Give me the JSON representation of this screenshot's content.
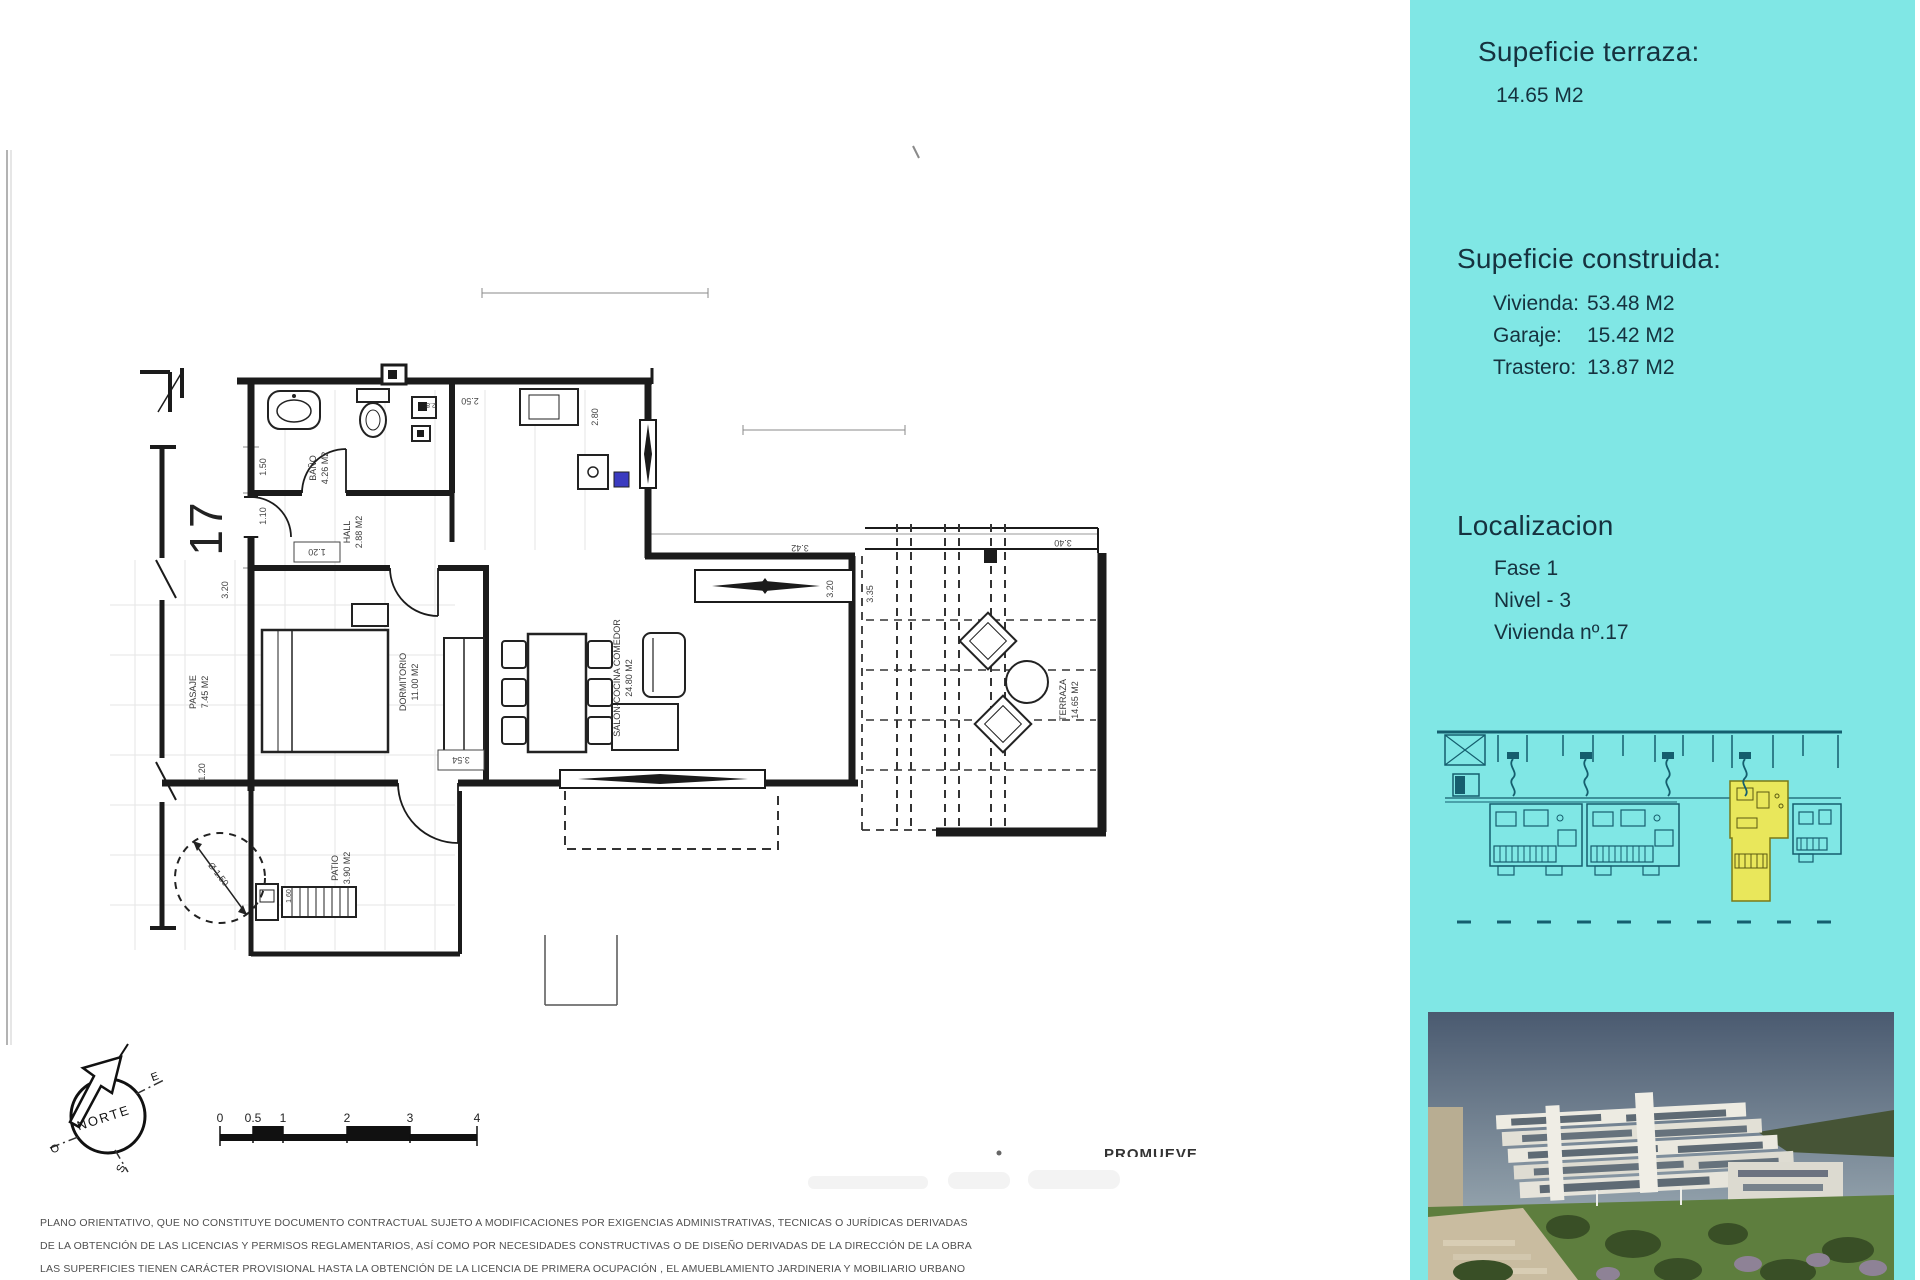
{
  "colors": {
    "panel_bg": "#80E7E5",
    "panel_text": "#16323F",
    "highlight_unit": "#E9E75B",
    "thumb_line": "#155E6E",
    "door_marker_blue": "#3B3BC0"
  },
  "sidebar": {
    "terrace": {
      "heading": "Supeficie terraza:",
      "value": "14.65 M2"
    },
    "built": {
      "heading": "Supeficie construida:",
      "rows": [
        {
          "label": "Vivienda:",
          "value": "53.48 M2"
        },
        {
          "label": "Garaje:",
          "value": "15.42 M2"
        },
        {
          "label": "Trastero:",
          "value": "13.87 M2"
        }
      ]
    },
    "location": {
      "heading": "Localizacion",
      "lines": [
        "Fase 1",
        "Nivel - 3",
        "Vivienda nº.17"
      ]
    }
  },
  "plan": {
    "unit_number": "17",
    "rooms": {
      "bano": {
        "name": "BAÑO",
        "area": "4.26 M2"
      },
      "hall": {
        "name": "HALL",
        "area": "2.88 M2"
      },
      "dormitorio": {
        "name": "DORMITORIO",
        "area": "11.00 M2"
      },
      "salon": {
        "name": "SALON-COCINA COMEDOR",
        "area": "24.80 M2"
      },
      "terraza": {
        "name": "TERRAZA",
        "area": "14.65 M2"
      },
      "pasaje": {
        "name": "PASAJE",
        "area": "7.45 M2"
      },
      "patio": {
        "name": "PATIO",
        "area": "3.90 M2"
      }
    },
    "dims": {
      "bath_height": "1.50",
      "entry_width": "1.10",
      "hall_width": "1.20",
      "passage_width": "1.20",
      "kitchen_width": "2.50",
      "kitchen_depth": "2.80",
      "bath_fixture": "2.8",
      "salon_width": "3.42",
      "salon_window": "3.20",
      "dorm_side": "3.20",
      "terrace_depth": "3.35",
      "terrace_width": "3.40",
      "dorm_width": "3.54",
      "passage_circle": "Ø 1.50",
      "patio_detail": "1.60"
    }
  },
  "compass": {
    "north": "NORTE",
    "east": "E",
    "south": "S",
    "west": "O"
  },
  "scalebar": {
    "labels": [
      "0",
      "0.5",
      "1",
      "2",
      "3",
      "4"
    ]
  },
  "footer": {
    "promoter": "PROMUEVE",
    "disclaimer": [
      "PLANO ORIENTATIVO, QUE NO CONSTITUYE DOCUMENTO CONTRACTUAL SUJETO A MODIFICACIONES POR EXIGENCIAS ADMINISTRATIVAS, TECNICAS O JURÍDICAS DERIVADAS",
      "DE LA OBTENCIÓN DE LAS LICENCIAS Y PERMISOS REGLAMENTARIOS, ASÍ COMO POR NECESIDADES CONSTRUCTIVAS  O DE DISEÑO DERIVADAS DE LA DIRECCIÓN DE LA OBRA",
      "LAS SUPERFICIES TIENEN CARÁCTER PROVISIONAL HASTA LA OBTENCIÓN DE LA LICENCIA DE PRIMERA OCUPACIÓN , EL AMUEBLAMIENTO JARDINERIA Y MOBILIARIO URBANO"
    ]
  }
}
